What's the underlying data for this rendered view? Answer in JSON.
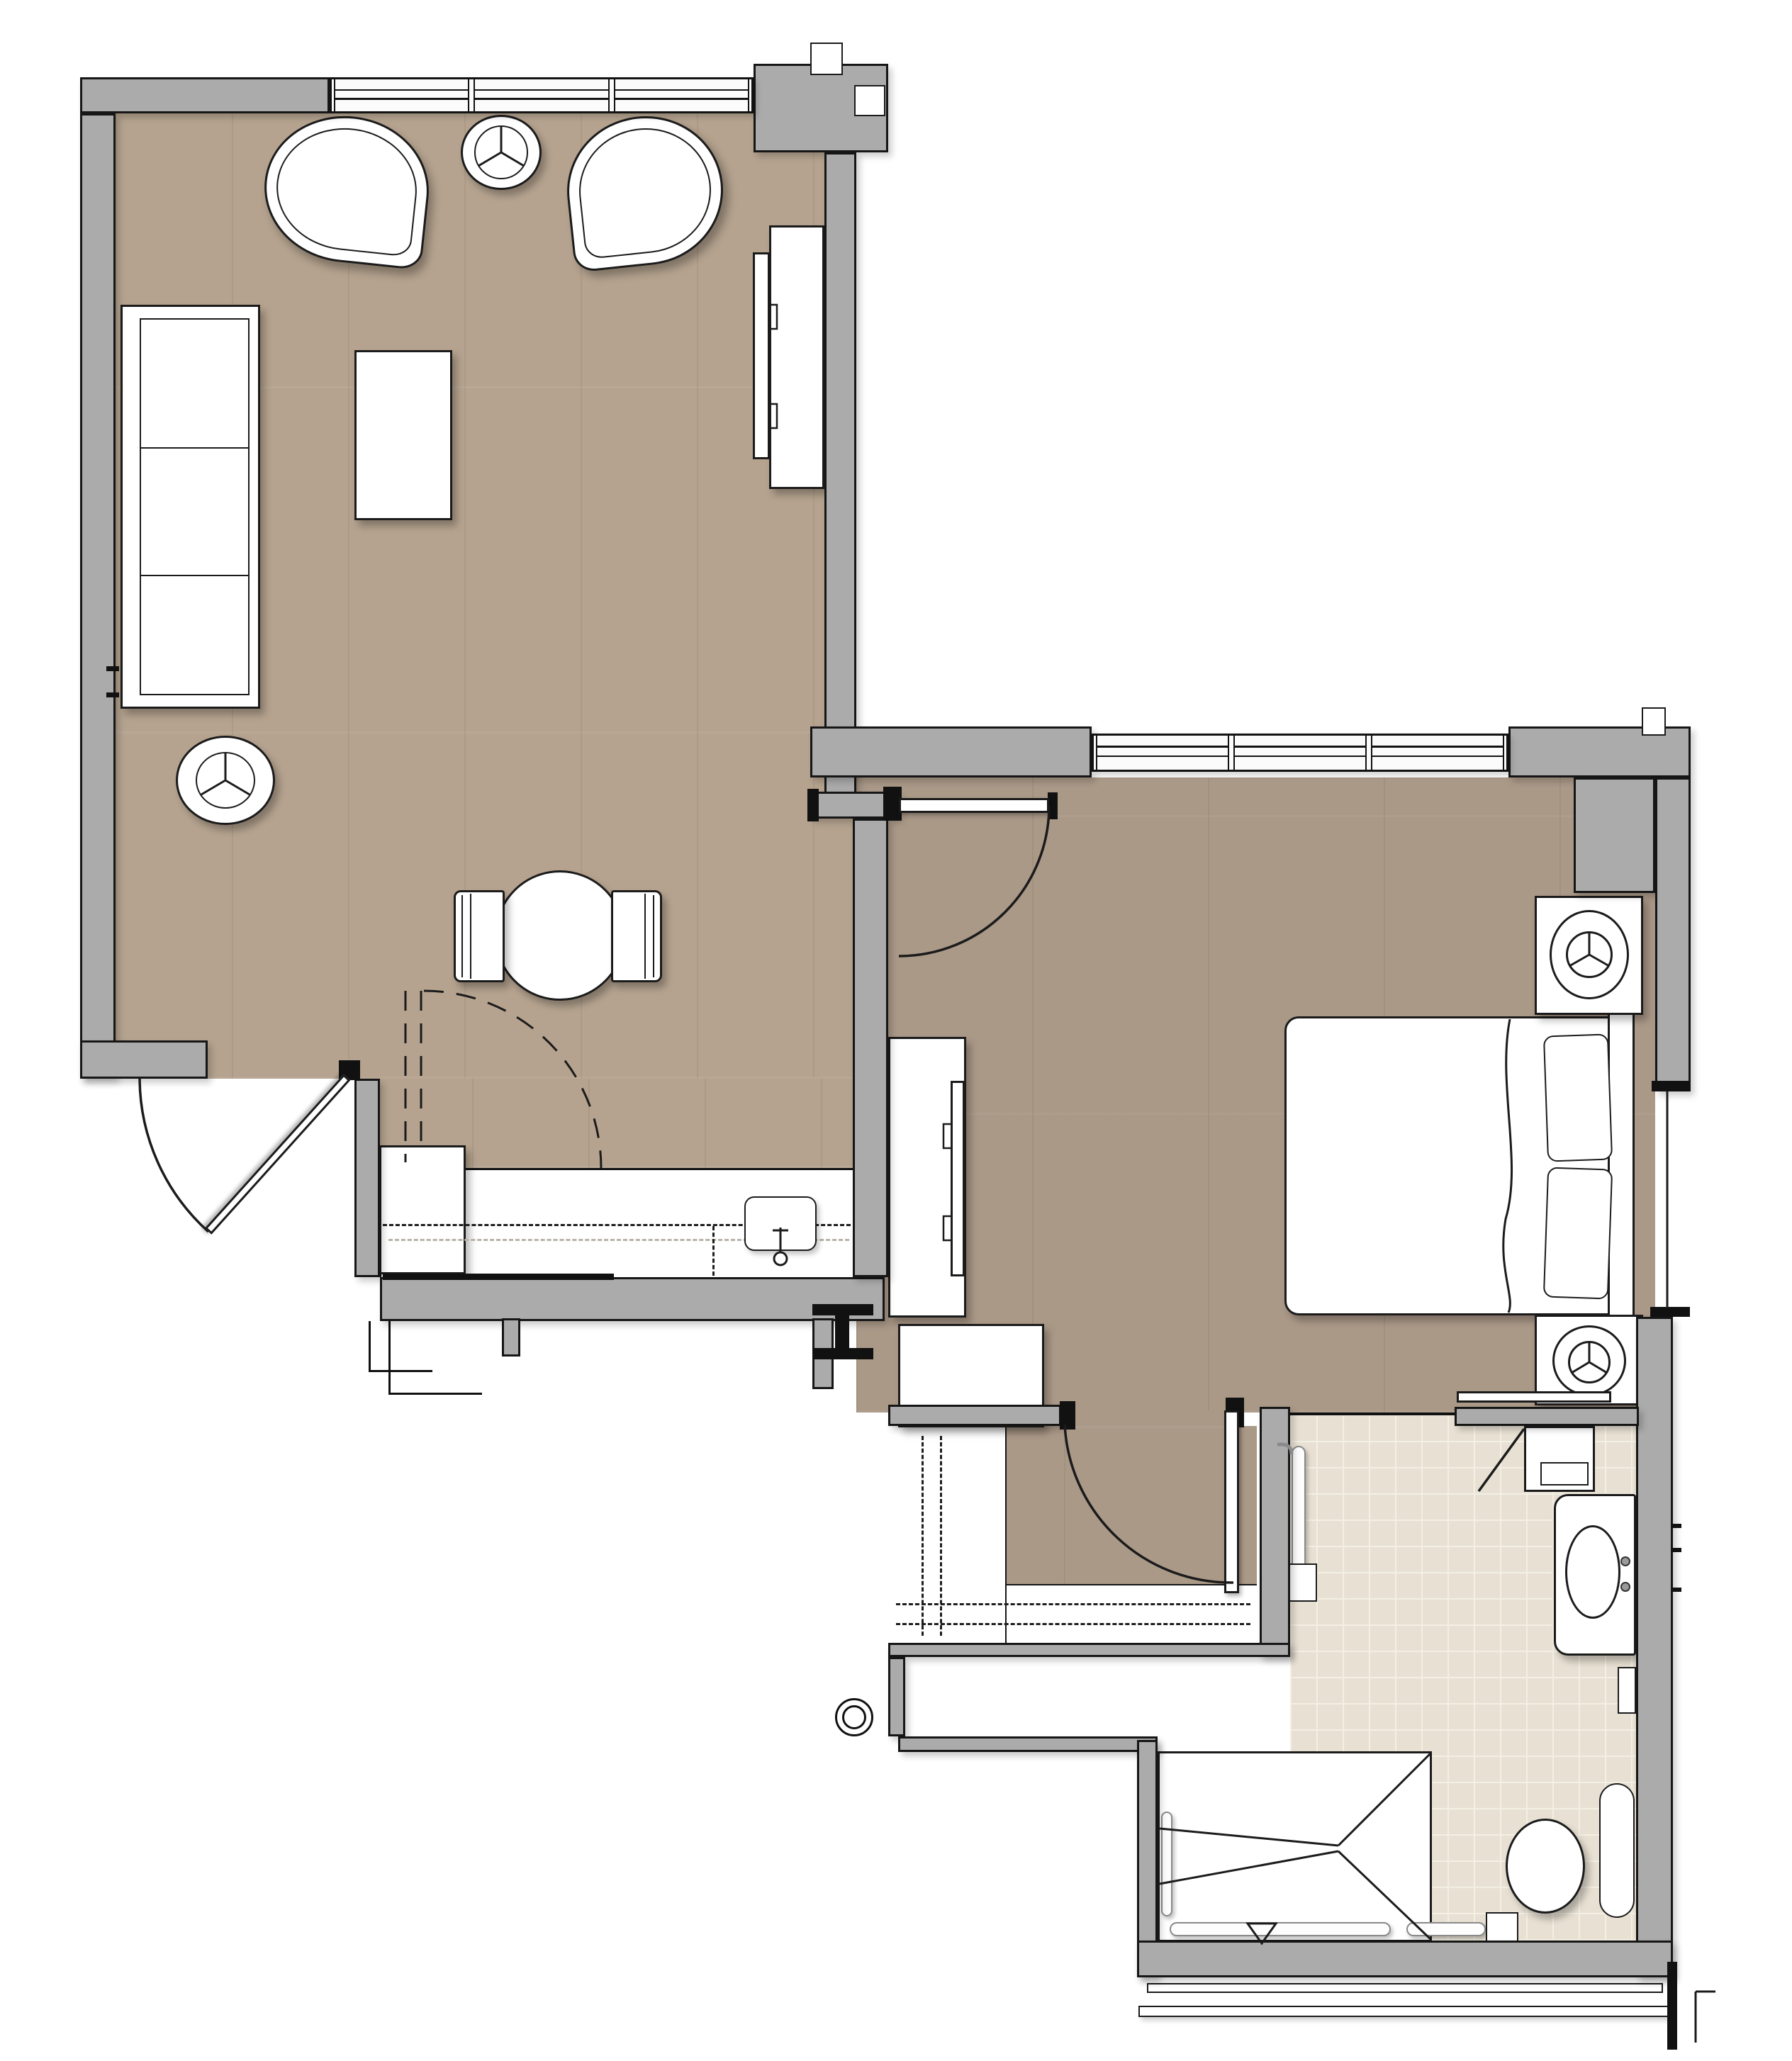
{
  "document": {
    "type": "architectural floor plan",
    "description": "Plan view of a one-bedroom suite: living/dining room with kitchenette, bedroom, walk-in closet and accessible bathroom. No text labels are rendered on the drawing.",
    "visible_text": []
  },
  "palette": {
    "wall": "#ababab",
    "line": "#1b1b1b",
    "exterior": "#ffffff",
    "wood_light": "#b5a38f",
    "wood_dark": "#ab9988",
    "tile": "#e8e1d3",
    "tile_grout": "#f4efe4",
    "fixture": "#ffffff",
    "grab_bar_outline": "#8a8a8a"
  },
  "rooms": [
    {
      "id": "living-dining",
      "floor": "wood-light",
      "features": [
        "three-pane-window-north",
        "entry-door-southwest",
        "lounge-chair-left",
        "lounge-chair-right",
        "round-side-table-top",
        "sofa-west-wall",
        "round-side-table-bottom",
        "coffee-table",
        "media-console-east-wall",
        "tv-on-console",
        "dining-table-round",
        "dining-chair-west",
        "dining-chair-east"
      ]
    },
    {
      "id": "kitchenette",
      "floor": "wood-light",
      "features": [
        "refrigerator",
        "base-counter",
        "sink-with-faucet",
        "upper-cabinets-dashed",
        "dashed-folding-door"
      ]
    },
    {
      "id": "bedroom",
      "floor": "wood-dark",
      "features": [
        "three-pane-window-north",
        "swing-door-from-living",
        "queen-bed",
        "two-pillows",
        "headboard",
        "nightstand-north-with-lamp",
        "nightstand-south-with-lamp",
        "media-console-west-wall",
        "tv-on-console",
        "wall-shelf-south"
      ]
    },
    {
      "id": "walk-in-closet",
      "floor": "wood-dark",
      "features": [
        "swing-door-from-bedroom",
        "wire-shelving-west-dashed",
        "wire-shelving-south-dashed",
        "storage-cabinet"
      ]
    },
    {
      "id": "bathroom",
      "floor": "tile",
      "features": [
        "open-doorway-from-bedroom",
        "angled-linen-cabinet",
        "vanity-with-oval-sink",
        "toilet",
        "vertical-grab-bar-wall",
        "l-grab-bar-entry",
        "roll-in-shower",
        "shower-slope-lines",
        "floor-drain-triangle",
        "grab-bars-south",
        "grab-bar-west"
      ]
    }
  ],
  "windows": [
    {
      "id": "living-window",
      "panes": 3
    },
    {
      "id": "bedroom-window",
      "panes": 3
    }
  ],
  "doors": [
    {
      "id": "entry-door",
      "swing": "out-southwest"
    },
    {
      "id": "bedroom-door",
      "swing": "south-into-hall"
    },
    {
      "id": "closet-door",
      "swing": "southwest-into-closet"
    },
    {
      "id": "kitchen-folding-door",
      "style": "dashed"
    }
  ],
  "symbols": [
    {
      "id": "column-marker-square-1"
    },
    {
      "id": "column-marker-square-2"
    },
    {
      "id": "column-marker-square-3"
    },
    {
      "id": "steel-beam-section-marker"
    },
    {
      "id": "pipe-riser-circle"
    },
    {
      "id": "wall-section-cut-marker"
    },
    {
      "id": "exterior-step-lines"
    }
  ]
}
